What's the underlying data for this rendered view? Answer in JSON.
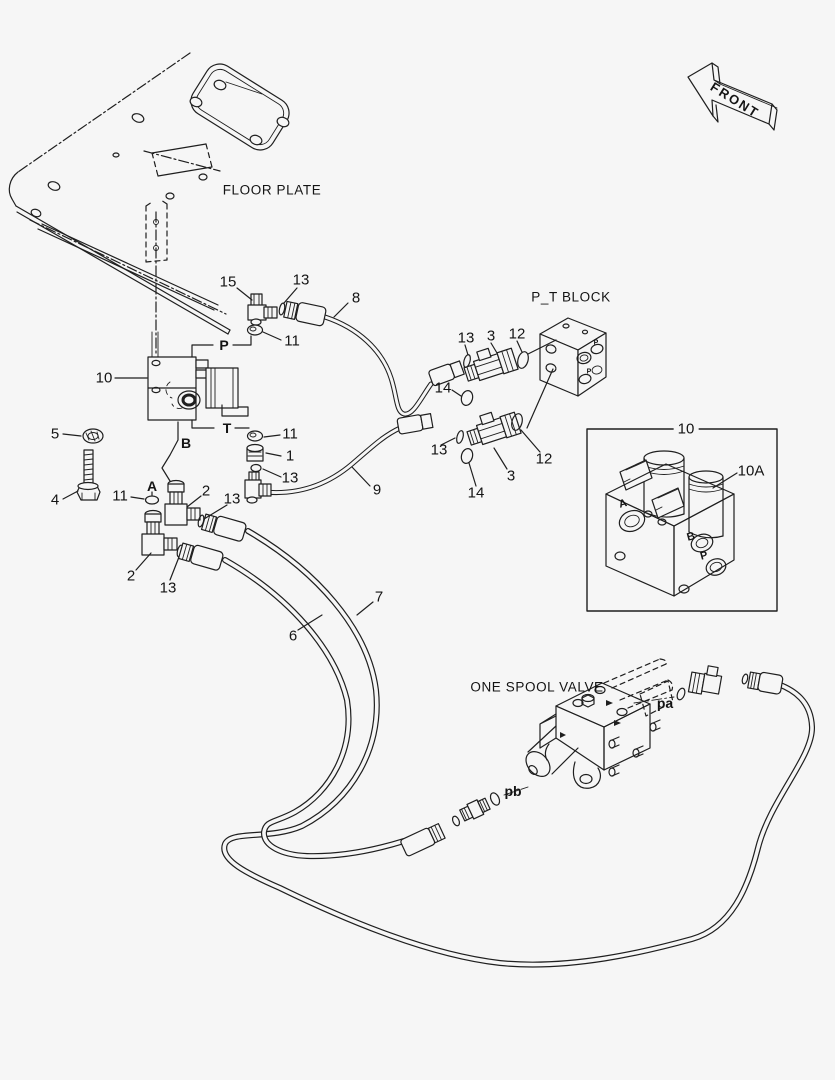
{
  "page": {
    "background_color": "#f6f6f6",
    "line_color": "#1f1f1f",
    "description": "Hydraulic piping exploded parts diagram"
  },
  "labels": [
    {
      "id": "title-floor-plate",
      "text": "FLOOR PLATE",
      "x": 272,
      "y": 190,
      "c": "title"
    },
    {
      "id": "title-pt-block",
      "text": "P_T BLOCK",
      "x": 571,
      "y": 297,
      "c": "title"
    },
    {
      "id": "title-one-spool-valve",
      "text": "ONE SPOOL VALVE",
      "x": 537,
      "y": 687,
      "c": "title"
    },
    {
      "id": "front-arrow-text",
      "text": "FRONT",
      "x": 735,
      "y": 100,
      "c": "front",
      "r": 32
    },
    {
      "id": "callout-10",
      "text": "10",
      "x": 104,
      "y": 378,
      "c": "num"
    },
    {
      "id": "callout-15",
      "text": "15",
      "x": 228,
      "y": 282,
      "c": "num"
    },
    {
      "id": "callout-13a",
      "text": "13",
      "x": 301,
      "y": 280,
      "c": "num"
    },
    {
      "id": "callout-8",
      "text": "8",
      "x": 356,
      "y": 298,
      "c": "num"
    },
    {
      "id": "port-p",
      "text": "P",
      "x": 224,
      "y": 345,
      "c": "port"
    },
    {
      "id": "callout-11a",
      "text": "11",
      "x": 292,
      "y": 341,
      "c": "num"
    },
    {
      "id": "port-t",
      "text": "T",
      "x": 227,
      "y": 428,
      "c": "port"
    },
    {
      "id": "callout-11b",
      "text": "11",
      "x": 290,
      "y": 434,
      "c": "num"
    },
    {
      "id": "callout-1",
      "text": "1",
      "x": 290,
      "y": 456,
      "c": "num"
    },
    {
      "id": "callout-13b",
      "text": "13",
      "x": 290,
      "y": 478,
      "c": "num"
    },
    {
      "id": "callout-9",
      "text": "9",
      "x": 377,
      "y": 490,
      "c": "num"
    },
    {
      "id": "callout-5",
      "text": "5",
      "x": 55,
      "y": 434,
      "c": "num"
    },
    {
      "id": "port-b",
      "text": "B",
      "x": 186,
      "y": 443,
      "c": "port"
    },
    {
      "id": "callout-4",
      "text": "4",
      "x": 55,
      "y": 500,
      "c": "num"
    },
    {
      "id": "callout-11c",
      "text": "11",
      "x": 120,
      "y": 496,
      "c": "num"
    },
    {
      "id": "port-a",
      "text": "A",
      "x": 152,
      "y": 486,
      "c": "port"
    },
    {
      "id": "callout-2a",
      "text": "2",
      "x": 206,
      "y": 491,
      "c": "num"
    },
    {
      "id": "callout-13c",
      "text": "13",
      "x": 232,
      "y": 499,
      "c": "num"
    },
    {
      "id": "callout-2b",
      "text": "2",
      "x": 131,
      "y": 576,
      "c": "num"
    },
    {
      "id": "callout-13d",
      "text": "13",
      "x": 168,
      "y": 588,
      "c": "num"
    },
    {
      "id": "callout-6",
      "text": "6",
      "x": 293,
      "y": 636,
      "c": "num"
    },
    {
      "id": "callout-7",
      "text": "7",
      "x": 379,
      "y": 597,
      "c": "num"
    },
    {
      "id": "callout-13e",
      "text": "13",
      "x": 466,
      "y": 338,
      "c": "num"
    },
    {
      "id": "callout-3a",
      "text": "3",
      "x": 491,
      "y": 336,
      "c": "num"
    },
    {
      "id": "callout-12a",
      "text": "12",
      "x": 517,
      "y": 334,
      "c": "num"
    },
    {
      "id": "callout-14a",
      "text": "14",
      "x": 443,
      "y": 388,
      "c": "num"
    },
    {
      "id": "callout-13f",
      "text": "13",
      "x": 439,
      "y": 450,
      "c": "num"
    },
    {
      "id": "callout-3b",
      "text": "3",
      "x": 511,
      "y": 476,
      "c": "num"
    },
    {
      "id": "callout-14b",
      "text": "14",
      "x": 476,
      "y": 493,
      "c": "num"
    },
    {
      "id": "callout-12b",
      "text": "12",
      "x": 544,
      "y": 459,
      "c": "num"
    },
    {
      "id": "inset-callout-10",
      "text": "10",
      "x": 686,
      "y": 429,
      "c": "num boxed"
    },
    {
      "id": "inset-callout-10a",
      "text": "10A",
      "x": 751,
      "y": 471,
      "c": "num"
    },
    {
      "id": "inset-port-a",
      "text": "A",
      "x": 623,
      "y": 504,
      "c": "port-sm",
      "r": -15
    },
    {
      "id": "inset-port-b",
      "text": "B",
      "x": 691,
      "y": 537,
      "c": "port-sm",
      "r": -15
    },
    {
      "id": "inset-port-p",
      "text": "P",
      "x": 704,
      "y": 556,
      "c": "port-sm",
      "r": -15
    },
    {
      "id": "pt-port-p1",
      "text": "P",
      "x": 596,
      "y": 343,
      "c": "tiny"
    },
    {
      "id": "pt-port-p2",
      "text": "P",
      "x": 589,
      "y": 372,
      "c": "tiny"
    },
    {
      "id": "port-pa",
      "text": "pa",
      "x": 665,
      "y": 703,
      "c": "port"
    },
    {
      "id": "port-pb",
      "text": "pb",
      "x": 513,
      "y": 791,
      "c": "port"
    }
  ]
}
